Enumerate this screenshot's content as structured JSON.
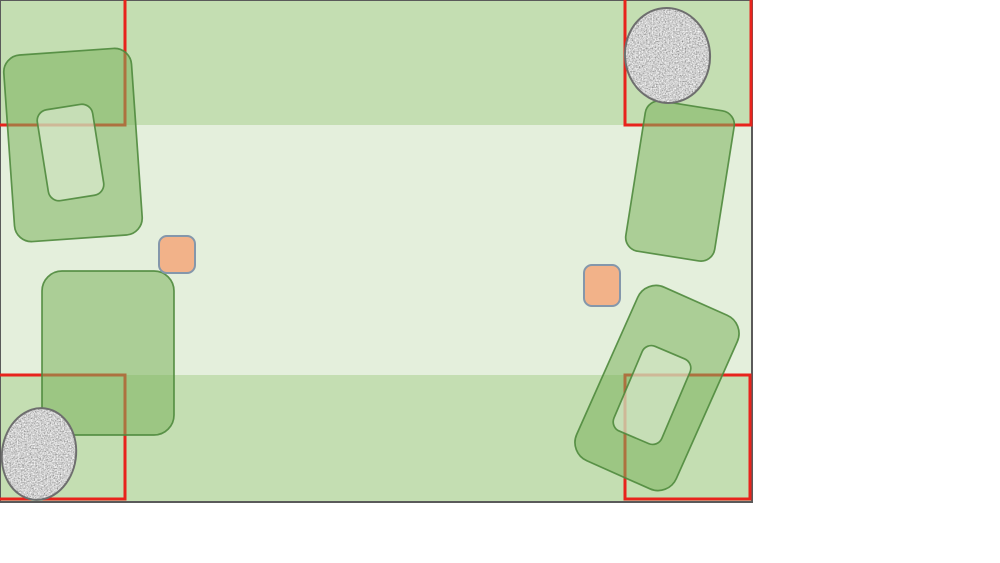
{
  "scene": {
    "width": 753,
    "height": 503,
    "colors": {
      "page_bg": "#ffffff",
      "field": "#c4deb2",
      "band": "#e4efdc",
      "frame": "#5a5a5a",
      "zone_stroke": "#e8231c",
      "bed_fill": "#7cb25c",
      "bed_stroke": "#4f8a3d",
      "inner_fill": "#e9f3e0",
      "rock_base": "#ababab",
      "rock_stroke": "#6e6e6e",
      "marker_fill": "#f2b289",
      "marker_stroke": "#8497ab"
    },
    "band": {
      "x": 0,
      "y": 125,
      "width": 753,
      "height": 250
    },
    "zones": [
      {
        "name": "zone-top-left",
        "x": -3,
        "y": -3,
        "w": 128,
        "h": 128
      },
      {
        "name": "zone-top-right",
        "x": 625,
        "y": -3,
        "w": 126,
        "h": 128
      },
      {
        "name": "zone-bottom-left",
        "x": -3,
        "y": 375,
        "w": 128,
        "h": 124
      },
      {
        "name": "zone-bottom-right",
        "x": 625,
        "y": 375,
        "w": 125,
        "h": 124
      }
    ],
    "zone_stroke_width": 3,
    "beds": [
      {
        "name": "bed-top-left",
        "kind": "bed",
        "cx": 73,
        "cy": 145,
        "w": 128,
        "h": 187,
        "r": 17,
        "rot": -4
      },
      {
        "name": "bed-top-left-inner",
        "kind": "inner",
        "cx": 70.5,
        "cy": 152.5,
        "w": 56,
        "h": 92,
        "r": 11,
        "rot": -9
      },
      {
        "name": "bed-mid-left",
        "kind": "bed",
        "cx": 108,
        "cy": 353,
        "w": 132,
        "h": 164,
        "r": 20,
        "rot": 0
      },
      {
        "name": "bed-top-right",
        "kind": "bed",
        "cx": 680,
        "cy": 181,
        "w": 90,
        "h": 152,
        "r": 14,
        "rot": 9
      },
      {
        "name": "bed-bottom-right",
        "kind": "bed",
        "cx": 657,
        "cy": 388,
        "w": 109,
        "h": 190,
        "r": 20,
        "rot": 24
      },
      {
        "name": "bed-bottom-right-inner",
        "kind": "inner",
        "cx": 652,
        "cy": 395,
        "w": 52,
        "h": 92,
        "r": 10,
        "rot": 23
      }
    ],
    "bed_fill_opacity": 0.55,
    "bed_stroke_width": 1.7,
    "rocks": [
      {
        "name": "rock-top-right",
        "cx": 667.5,
        "cy": 55.5,
        "rx": 42.5,
        "ry": 47.5,
        "rot": -6
      },
      {
        "name": "rock-bottom-left",
        "cx": 39,
        "cy": 454,
        "rx": 37,
        "ry": 46,
        "rot": 8
      }
    ],
    "rock_stroke_width": 2,
    "markers": [
      {
        "name": "marker-left",
        "x": 159,
        "y": 236,
        "w": 36,
        "h": 37,
        "r": 8
      },
      {
        "name": "marker-right",
        "x": 584,
        "y": 265,
        "w": 36,
        "h": 41,
        "r": 8
      }
    ],
    "marker_stroke_width": 2,
    "frame_stroke_width": 2
  }
}
